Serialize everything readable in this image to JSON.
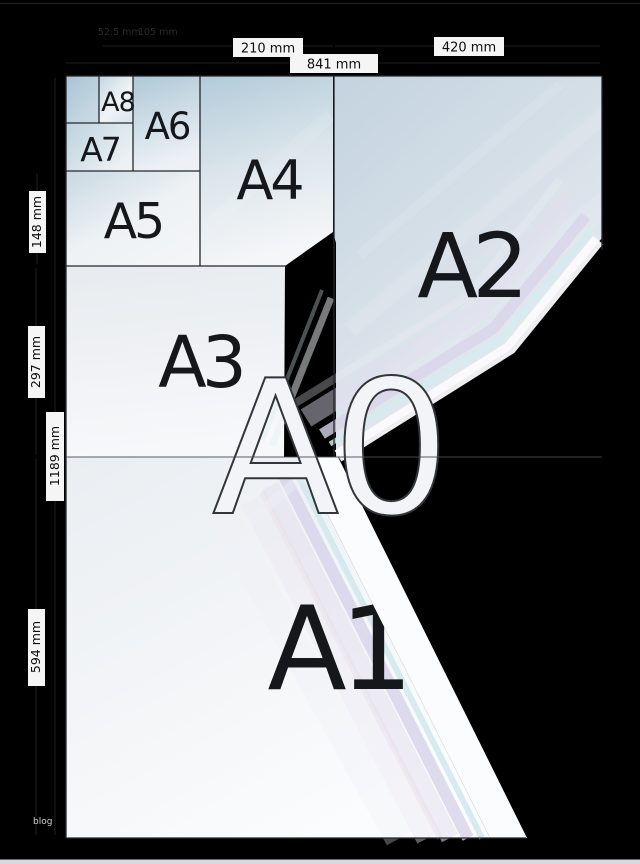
{
  "sheet_labels": {
    "a0": "A0",
    "a1": "A1",
    "a2": "A2",
    "a3": "A3",
    "a4": "A4",
    "a5": "A5",
    "a6": "A6",
    "a7": "A7",
    "a8": "A8"
  },
  "dimension_labels": {
    "top": {
      "a4_width": "210 mm",
      "a0_width": "841 mm",
      "a2_width": "420 mm"
    },
    "left": {
      "a5_height": "148 mm",
      "a3_height": "297 mm",
      "a0_height": "1189 mm",
      "a1_height": "594 mm"
    },
    "faint_top": {
      "a8_width": "52.5 mm",
      "a6_width": "105 mm"
    }
  },
  "watermark": "blog",
  "colors": {
    "background": "#000000",
    "paper_blue": "#b2cbd9",
    "paper_white": "#f6f7f9",
    "grid_line": "#24272b",
    "label_text": "#15171a",
    "outline_label_fill": "#f3f4f7",
    "outline_label_stroke": "#32353a",
    "dim_box_bg": "#f5f5f6",
    "dim_text": "#0e0e0e",
    "streak_white": "#fbfbfd",
    "streak_cyan": "#d2ecf1",
    "streak_lavender": "#d9d4eb",
    "bottom_strip": "#d6dadd"
  }
}
